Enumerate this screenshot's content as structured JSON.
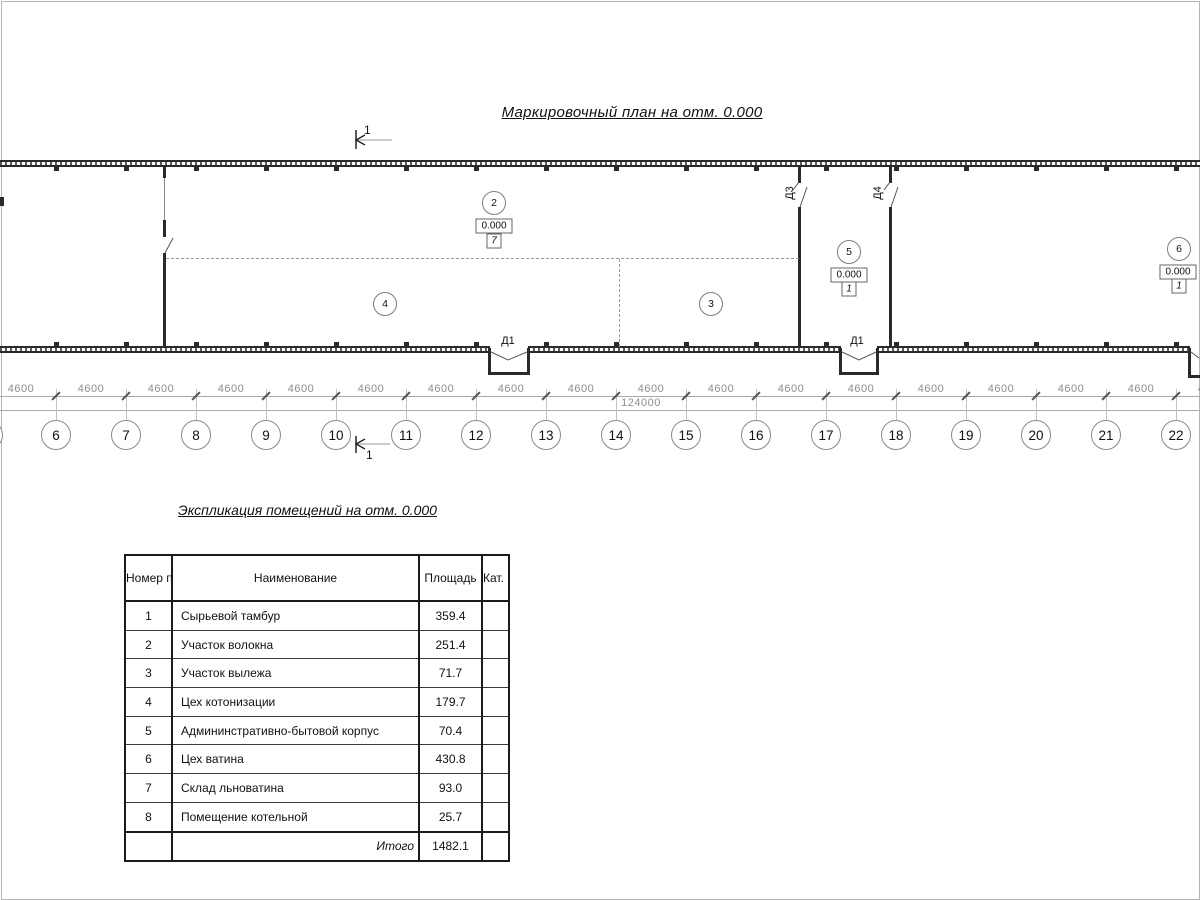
{
  "plan": {
    "title": "Маркировочный план на отм. 0.000",
    "section_mark": "1",
    "doors": {
      "d1a": "Д1",
      "d1b": "Д1",
      "d3": "Д3",
      "d4": "Д4"
    },
    "rooms": [
      {
        "num": "2",
        "x": 494,
        "y": 203,
        "elev": "0.000",
        "ex": 494,
        "ey": 226,
        "floor": "7",
        "fx": 494,
        "fy": 241
      },
      {
        "num": "4",
        "x": 385,
        "y": 304
      },
      {
        "num": "3",
        "x": 711,
        "y": 304
      },
      {
        "num": "5",
        "x": 849,
        "y": 252,
        "elev": "0.000",
        "ex": 849,
        "ey": 275,
        "floor": "1",
        "fx": 849,
        "fy": 289
      },
      {
        "num": "6",
        "x": 1179,
        "y": 249,
        "elev": "0.000",
        "ex": 1178,
        "ey": 272,
        "floor": "1",
        "fx": 1179,
        "fy": 286
      }
    ],
    "axes": {
      "labels": [
        "6",
        "7",
        "8",
        "9",
        "10",
        "11",
        "12",
        "13",
        "14",
        "15",
        "16",
        "17",
        "18",
        "19",
        "20",
        "21",
        "22"
      ],
      "start_x": 56,
      "step": 70,
      "partial_x": -12,
      "circle_y": 435
    },
    "dims": {
      "bay": "4600",
      "total": "124000"
    }
  },
  "table": {
    "title": "Экспликация помещений на отм. 0.000",
    "headers": {
      "num": "Номер помещ.",
      "name": "Наименование",
      "area": "Площадь",
      "cat": "Кат. пом."
    },
    "rows": [
      {
        "num": "1",
        "name": "Сырьевой тамбур",
        "area": "359.4",
        "cat": ""
      },
      {
        "num": "2",
        "name": "Участок волокна",
        "area": "251.4",
        "cat": ""
      },
      {
        "num": "3",
        "name": "Участок вылежа",
        "area": "71.7",
        "cat": ""
      },
      {
        "num": "4",
        "name": "Цех котонизации",
        "area": "179.7",
        "cat": ""
      },
      {
        "num": "5",
        "name": "Админинстративно-бытовой корпус",
        "area": "70.4",
        "cat": ""
      },
      {
        "num": "6",
        "name": "Цех ватина",
        "area": "430.8",
        "cat": ""
      },
      {
        "num": "7",
        "name": "Склад льноватина",
        "area": "93.0",
        "cat": ""
      },
      {
        "num": "8",
        "name": "Помещение котельной",
        "area": "25.7",
        "cat": ""
      }
    ],
    "footer": {
      "label": "Итого",
      "total": "1482.1",
      "cat": ""
    }
  }
}
